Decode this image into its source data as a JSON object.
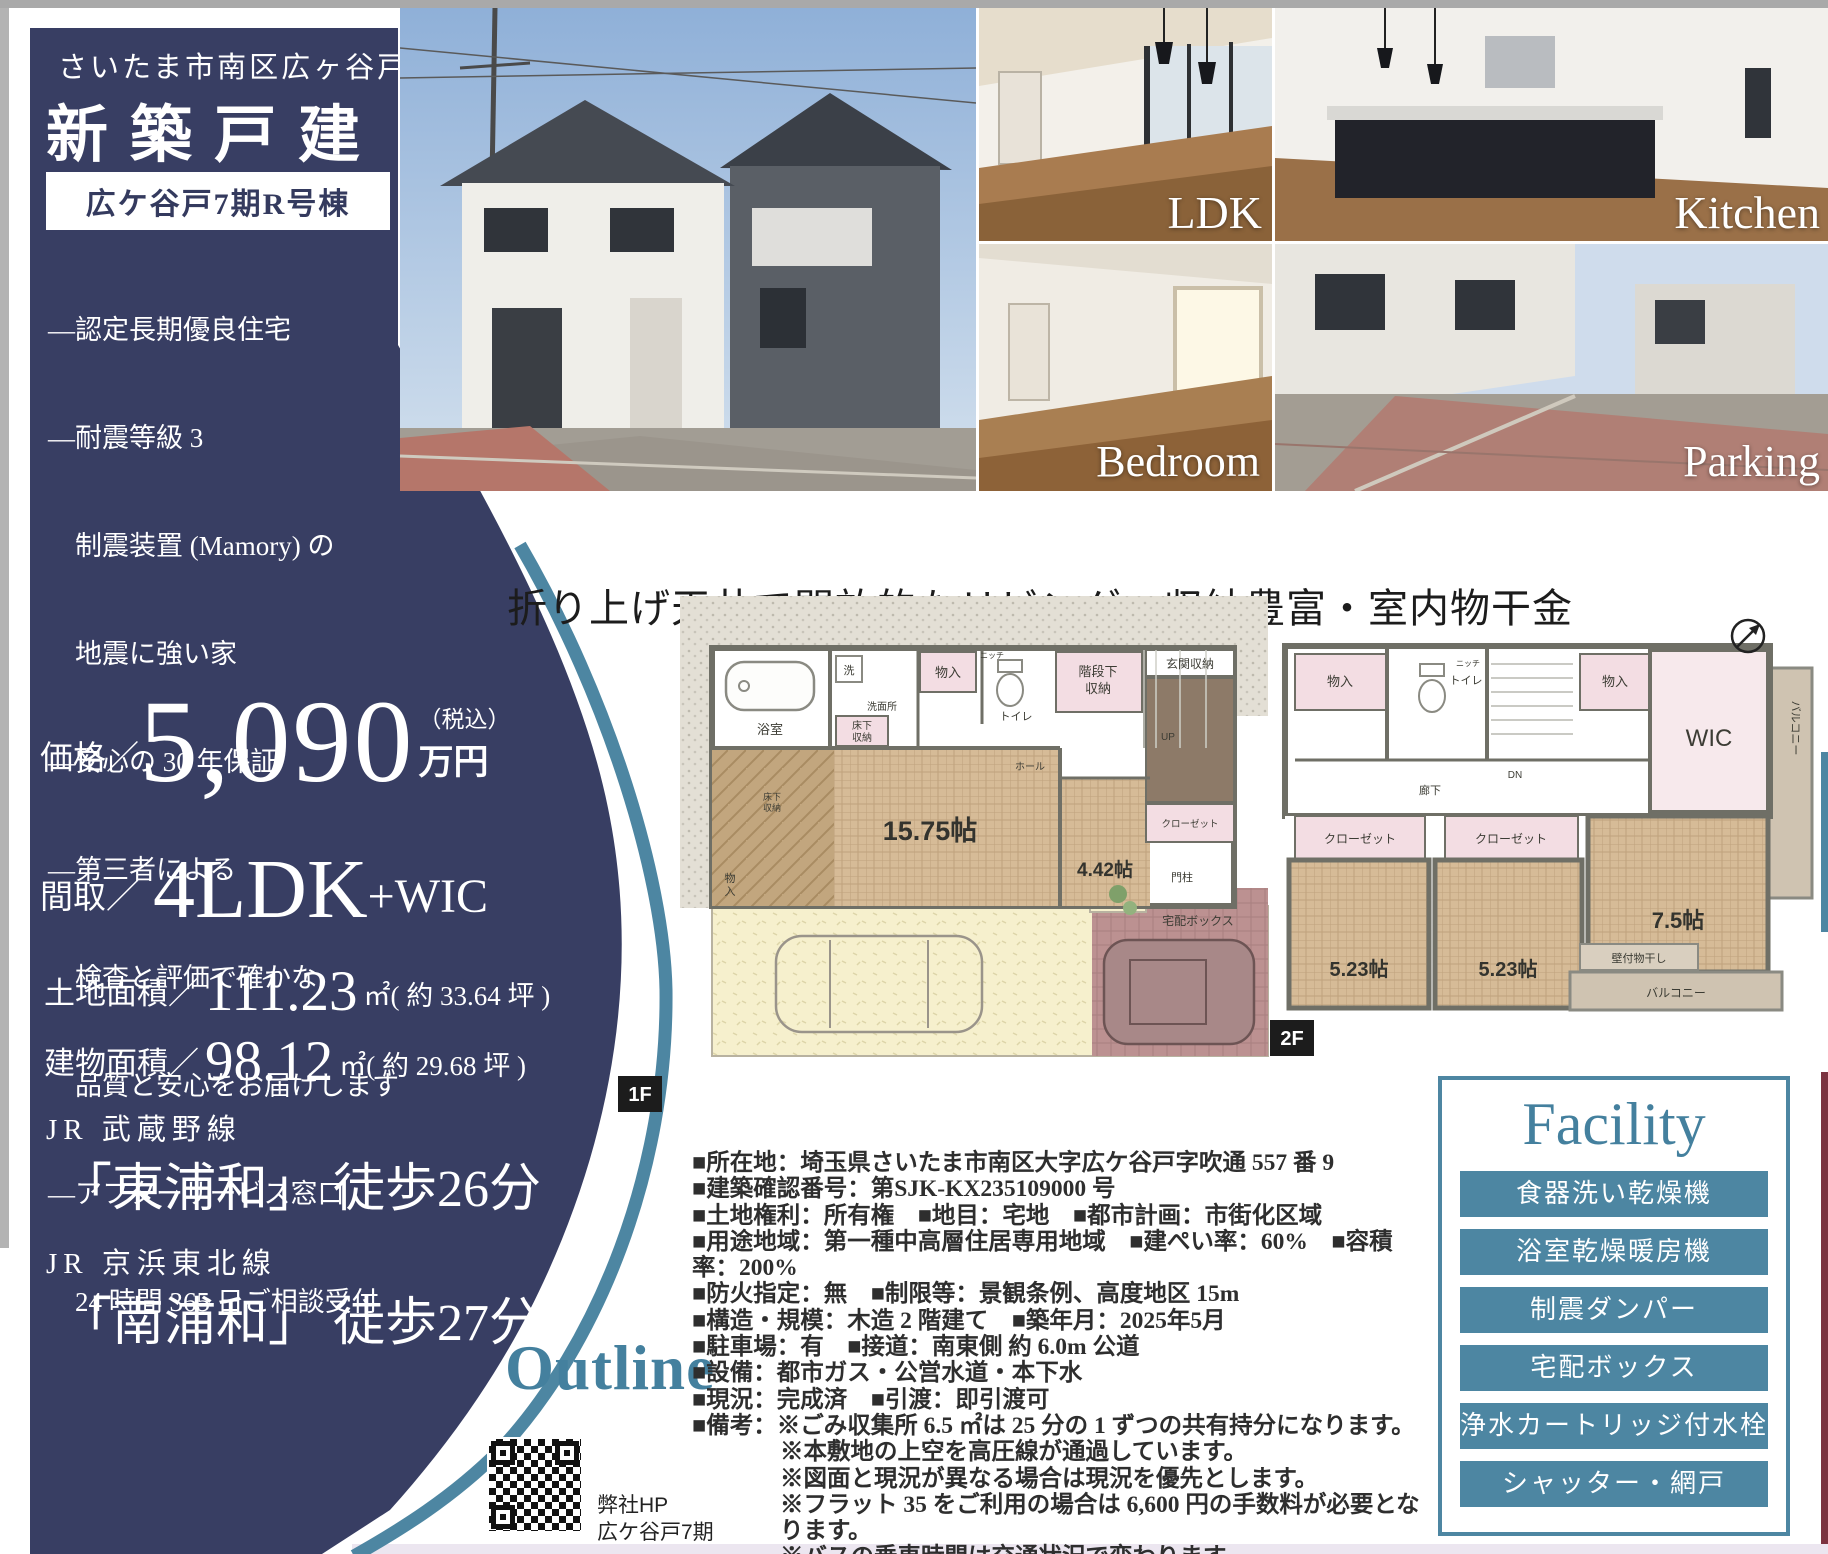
{
  "colors": {
    "navy": "#383e63",
    "accent_teal": "#4d86a2",
    "facility_title": "#44809e"
  },
  "sidebar": {
    "location": "さいたま市南区広ヶ谷戸",
    "title": "新築戸建",
    "badge": "広ケ谷戸7期R号棟",
    "features": [
      "―認定長期優良住宅",
      "―耐震等級 3",
      "　制震装置 (Mamory) の",
      "　地震に強い家",
      "―安心の 30 年保証",
      "―第三者による",
      "　検査と評価で確かな",
      "　品質と安心をお届けします",
      "―アフターサービス窓口",
      "　24 時間 365 日ご相談受付"
    ],
    "price_label": "価格／",
    "price_value": "5,090",
    "price_tax": "（税込）",
    "price_unit": "万円",
    "madori_label": "間取／",
    "madori_value": "4LDK",
    "madori_suffix": "+WIC",
    "land_label": "土地面積／",
    "land_value": "111.23",
    "land_unit": "㎡",
    "land_paren": "( 約 33.64 坪 )",
    "building_label": "建物面積／",
    "building_value": "98.12",
    "building_unit": "㎡",
    "building_paren": "( 約 29.68 坪 )",
    "line1_name": "JR 武蔵野線",
    "line1_station": "「東浦和」",
    "line1_walk": "徒歩26分",
    "line2_name": "JR 京浜東北線",
    "line2_station": "「南浦和」",
    "line2_walk": "徒歩27分"
  },
  "photos": {
    "ldk_label": "LDK",
    "kitchen_label": "Kitchen",
    "bedroom_label": "Bedroom",
    "parking_label": "Parking"
  },
  "headline": "折り上げ天井で開放的なリビング・収納豊富・室内物干金物付き",
  "floorplan": {
    "f1": {
      "tag": "1F",
      "bath": "浴室",
      "wash": "洗",
      "washroom": "洗面所",
      "underfloor_a1": "床下",
      "underfloor_a2": "収納",
      "storage_top": "物入",
      "niche": "ニッチ",
      "toilet": "トイレ",
      "stair_storage_1": "階段下",
      "stair_storage_2": "収納",
      "up": "UP",
      "hall": "ホール",
      "entrance_storage": "玄関収納",
      "closet": "クローゼット",
      "underfloor_b1": "床下",
      "underfloor_b2": "収納",
      "storage_side_1": "物",
      "storage_side_2": "入",
      "ldk_size": "15.75帖",
      "room_size": "4.42帖",
      "gate": "門柱",
      "delivery": "宅配ボックス"
    },
    "f2": {
      "tag": "2F",
      "storage1": "物入",
      "niche": "ニッチ",
      "toilet": "トイレ",
      "dn": "DN",
      "hallway": "廊下",
      "storage2": "物入",
      "wic": "WIC",
      "balcony1": "バルコニー",
      "closet1": "クローゼット",
      "closet2": "クローゼット",
      "room1_size": "5.23帖",
      "room2_size": "5.23帖",
      "room3_size": "7.5帖",
      "drying": "壁付物干し",
      "balcony2": "バルコニー"
    }
  },
  "outline": {
    "title": "Outline",
    "lines": [
      "■所在地：埼玉県さいたま市南区大字広ケ谷戸字吹通 557 番 9",
      "■建築確認番号：第SJK-KX235109000 号",
      "■土地権利：所有権　■地目：宅地　■都市計画：市街化区域",
      "■用途地域：第一種中高層住居専用地域　■建ぺい率：60%　■容積率：200%",
      "■防火指定：無　■制限等：景観条例、高度地区 15m",
      "■構造・規模：木造 2 階建て　■築年月：2025年5月",
      "■駐車場：有　■接道：南東側 約 6.0m 公道",
      "■設備：都市ガス・公営水道・本下水",
      "■現況：完成済　■引渡：即引渡可",
      "■備考：※ごみ収集所 6.5 ㎡は 25 分の 1 ずつの共有持分になります。"
    ],
    "notes": [
      "※本敷地の上空を高圧線が通過しています。",
      "※図面と現況が異なる場合は現況を優先とします。",
      "※フラット 35 をご利用の場合は 6,600 円の手数料が必要となります。",
      "※バスの乗車時間は交通状況で変わります。",
      "※弊社指定司法書士・土地家屋調査士を利用して頂きます。"
    ],
    "qr_caption_1": "弊社HP",
    "qr_caption_2": "広ケ谷戸7期"
  },
  "facility": {
    "title": "Facility",
    "items": [
      "食器洗い乾燥機",
      "浴室乾燥暖房機",
      "制震ダンパー",
      "宅配ボックス",
      "浄水カートリッジ付水栓",
      "シャッター・網戸"
    ]
  }
}
